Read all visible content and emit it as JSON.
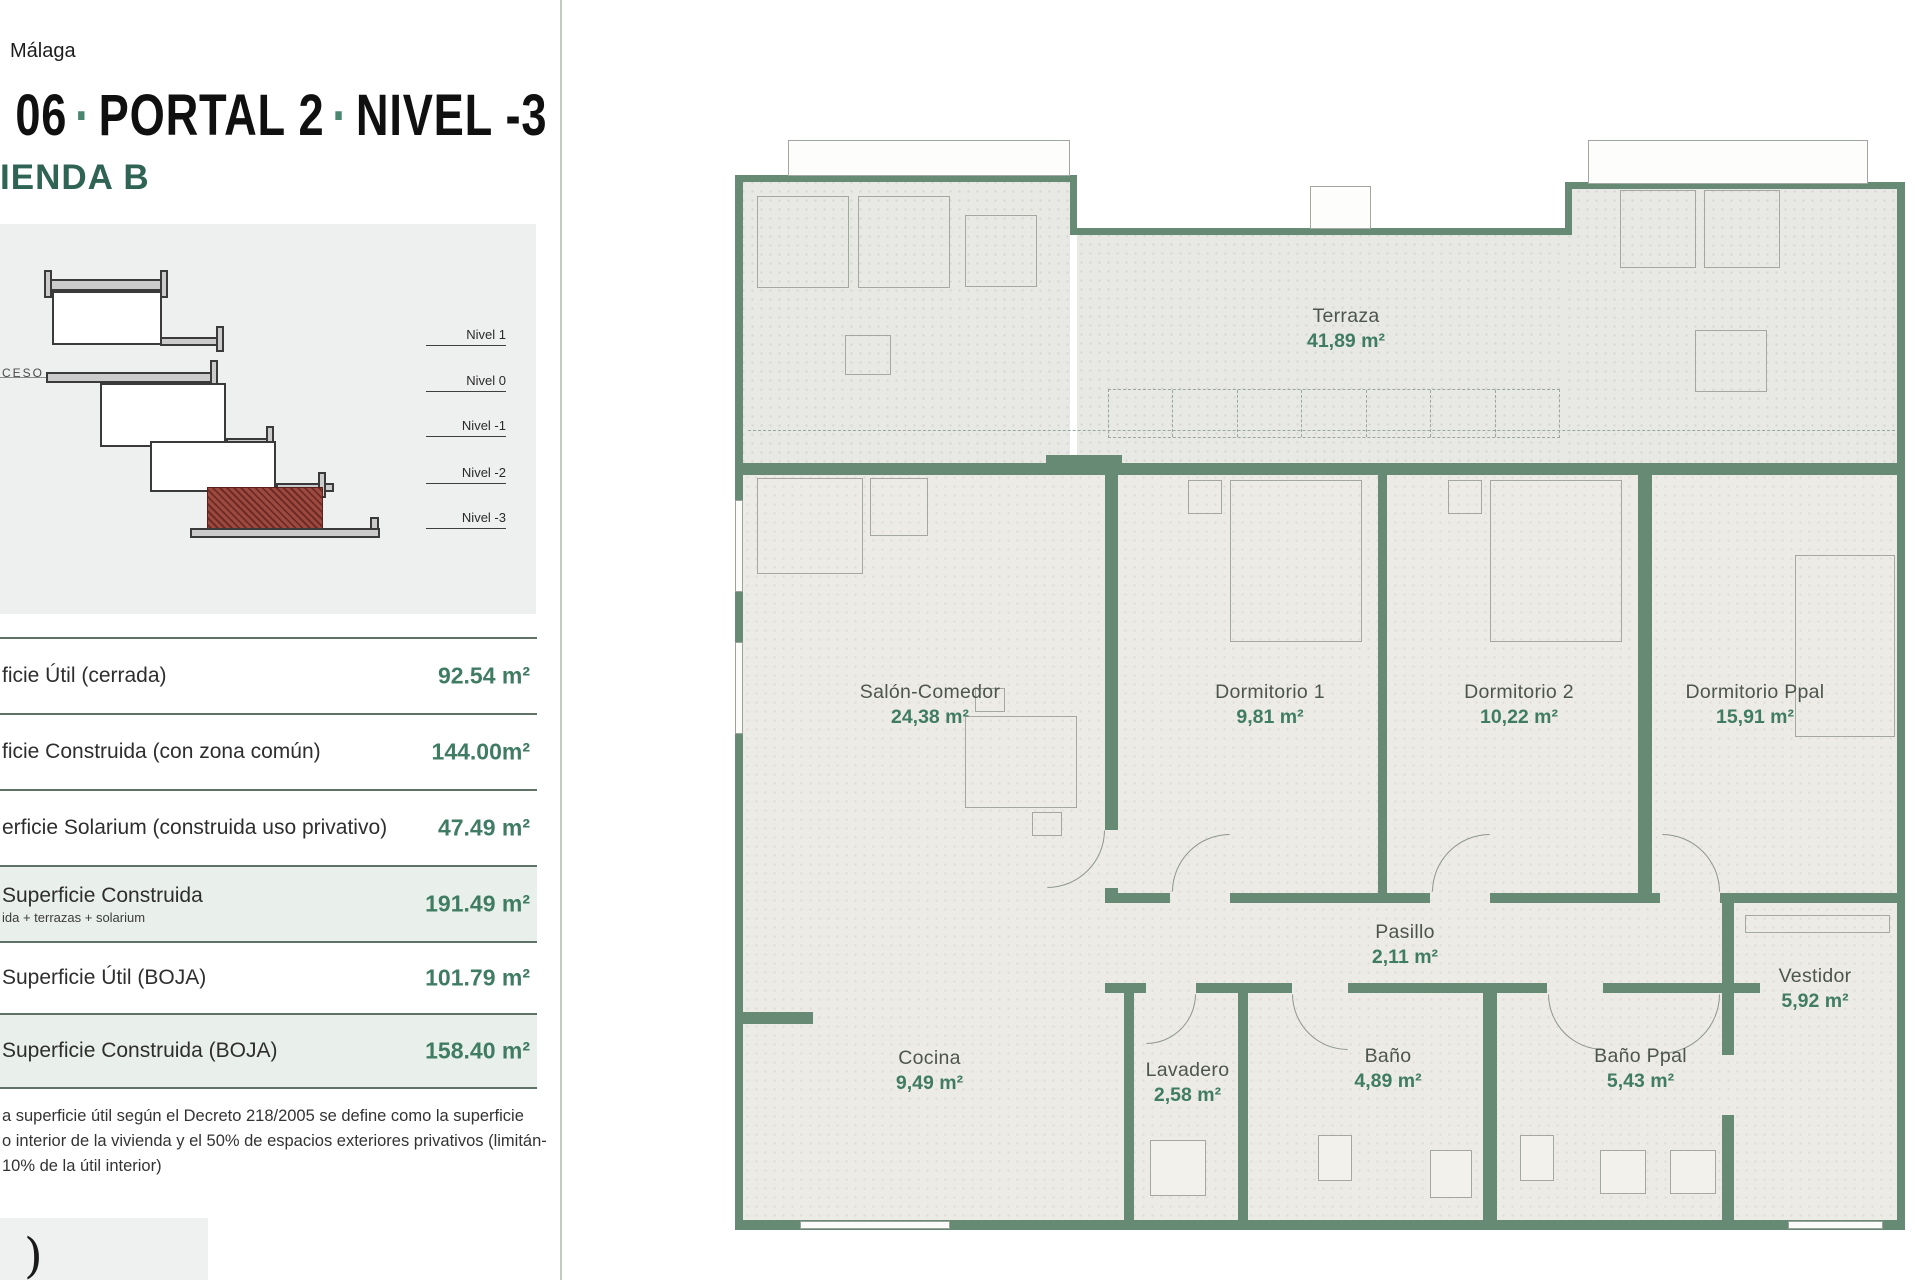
{
  "header": {
    "city": "Málaga",
    "title_clipped": "Q",
    "dot": "·",
    "title_parts": [
      "06",
      "PORTAL 2",
      "NIVEL -3"
    ],
    "unit": "IENDA B"
  },
  "section": {
    "access": "CESO",
    "levels": [
      "Nivel 1",
      "Nivel 0",
      "Nivel -1",
      "Nivel -2",
      "Nivel -3"
    ]
  },
  "table": {
    "rows": [
      {
        "label": "ficie Útil (cerrada)",
        "value": "92.54 m²"
      },
      {
        "label": "ficie Construida (con zona común)",
        "value": "144.00m²"
      },
      {
        "label": "erficie Solarium (construida uso privativo)",
        "value": "47.49 m²"
      },
      {
        "label": "Superficie Construida",
        "sub": "ida + terrazas + solarium",
        "value": "191.49 m²"
      },
      {
        "label": "Superficie Útil (BOJA)",
        "value": "101.79 m²"
      },
      {
        "label": "Superficie Construida (BOJA)",
        "value": "158.40 m²"
      }
    ]
  },
  "footnote": {
    "line1": "a superficie útil según el Decreto 218/2005 se define como la superficie",
    "line2": "o interior de la vivienda y el 50% de espacios exteriores privativos (limitán-",
    "line3": "10% de la útil interior)"
  },
  "logo": {
    "mark": ")"
  },
  "floor_plan": {
    "rooms": [
      {
        "name": "Terraza",
        "area": "41,89 m²"
      },
      {
        "name": "Salón-Comedor",
        "area": "24,38 m²"
      },
      {
        "name": "Dormitorio 1",
        "area": "9,81 m²"
      },
      {
        "name": "Dormitorio 2",
        "area": "10,22 m²"
      },
      {
        "name": "Dormitorio Ppal",
        "area": "15,91 m²"
      },
      {
        "name": "Pasillo",
        "area": "2,11 m²"
      },
      {
        "name": "Vestidor",
        "area": "5,92 m²"
      },
      {
        "name": "Cocina",
        "area": "9,49 m²"
      },
      {
        "name": "Lavadero",
        "area": "2,58 m²"
      },
      {
        "name": "Baño",
        "area": "4,89 m²"
      },
      {
        "name": "Baño Ppal",
        "area": "5,43 m²"
      }
    ]
  },
  "colors": {
    "accent_green": "#3f7c63",
    "wall_green": "#678a74",
    "title_green": "#2f6354",
    "hatch_red": "#8e423a"
  }
}
